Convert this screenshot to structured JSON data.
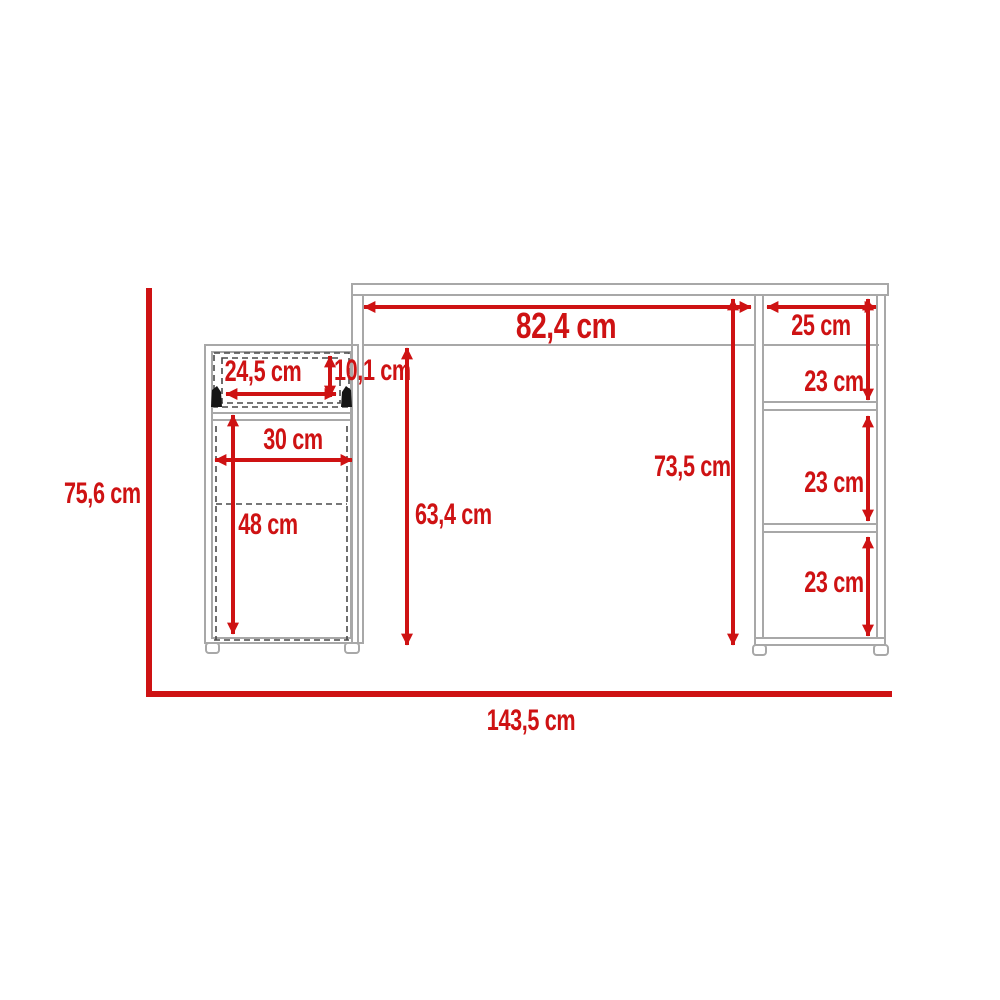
{
  "diagram": {
    "type": "furniture dimension drawing",
    "subject": "desk with drawer cabinet and side shelving unit",
    "unit": "cm",
    "colors": {
      "dimension_red": "#ce1213",
      "outline_gray": "#a8a8a8",
      "dashed_dark": "#4a4a4a"
    },
    "dimensions": {
      "overall_height": "75,6 cm",
      "overall_width": "143,5 cm",
      "desktop_width": "82,4 cm",
      "shelf_unit_width": "25 cm",
      "shelf_section_1": "23 cm",
      "shelf_section_2": "23 cm",
      "shelf_section_3": "23 cm",
      "drawer_width": "24,5 cm",
      "drawer_height": "10,1 cm",
      "cabinet_width": "30 cm",
      "door_height": "48 cm",
      "cabinet_side_height": "63,4 cm",
      "desk_clearance_height": "73,5 cm"
    }
  }
}
